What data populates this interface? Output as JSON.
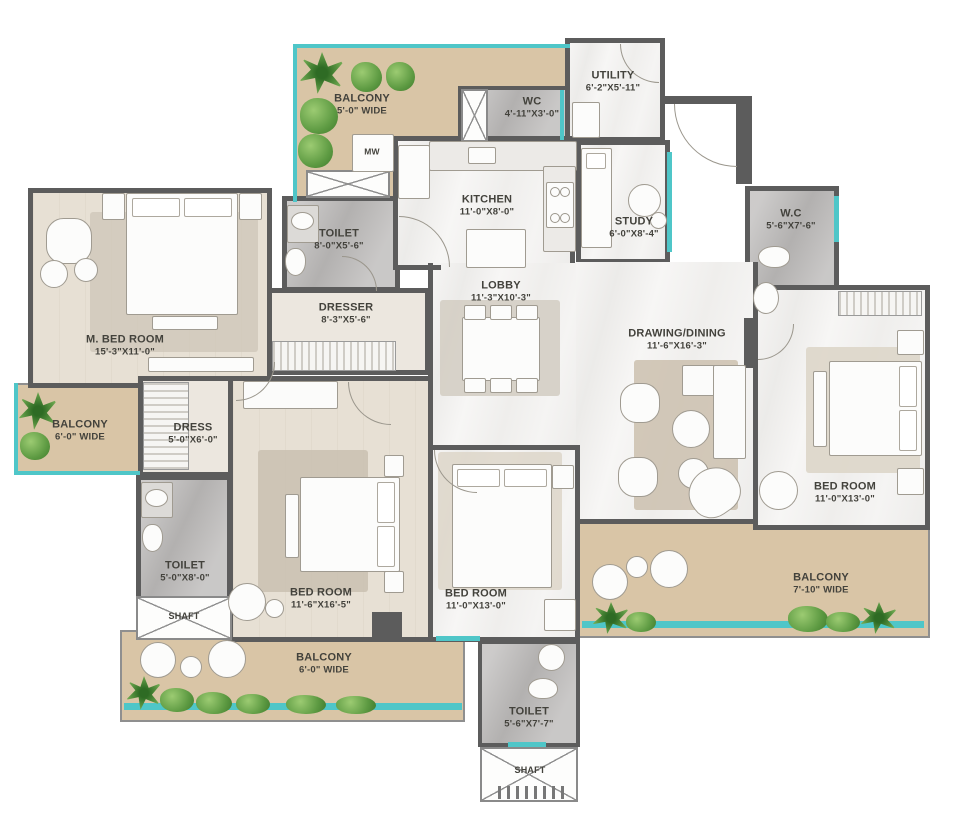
{
  "plan": {
    "title": "apartment-floor-plan",
    "colors": {
      "wall": "#5c5c5c",
      "balcony_floor": "#d9c5a6",
      "bedroom_floor": "#e7e0d4",
      "toilet_floor": "#bcbab9",
      "living_floor": "#f5f4f2",
      "window_accent": "#4fc6c8",
      "plant_green": "#5d9a42",
      "label_text": "#43423c"
    },
    "rooms": {
      "balcony_top": {
        "name": "BALCONY",
        "dims": "5'-0\" WIDE"
      },
      "wc_top": {
        "name": "WC",
        "dims": "4'-11\"X3'-0\""
      },
      "utility": {
        "name": "UTILITY",
        "dims": "6'-2\"X5'-11\""
      },
      "kitchen": {
        "name": "KITCHEN",
        "dims": "11'-0\"X8'-0\""
      },
      "study": {
        "name": "STUDY",
        "dims": "6'-0\"X8'-4\""
      },
      "wc_right": {
        "name": "W.C",
        "dims": "5'-6\"X7'-6\""
      },
      "toilet_top": {
        "name": "TOILET",
        "dims": "8'-0\"X5'-6\""
      },
      "dresser": {
        "name": "DRESSER",
        "dims": "8'-3\"X5'-6\""
      },
      "m_bedroom": {
        "name": "M. BED ROOM",
        "dims": "15'-3\"X11'-0\""
      },
      "lobby": {
        "name": "LOBBY",
        "dims": "11'-3\"X10'-3\""
      },
      "drawing_dining": {
        "name": "DRAWING/DINING",
        "dims": "11'-6\"X16'-3\""
      },
      "balcony_left": {
        "name": "BALCONY",
        "dims": "6'-0\" WIDE"
      },
      "dress": {
        "name": "DRESS",
        "dims": "5'-0\"X6'-0\""
      },
      "toilet_left": {
        "name": "TOILET",
        "dims": "5'-0\"X8'-0\""
      },
      "shaft_left": {
        "name": "SHAFT"
      },
      "bedroom_left": {
        "name": "BED ROOM",
        "dims": "11'-6\"X16'-5\""
      },
      "bedroom_center": {
        "name": "BED ROOM",
        "dims": "11'-0\"X13'-0\""
      },
      "balcony_bottom": {
        "name": "BALCONY",
        "dims": "6'-0\" WIDE"
      },
      "toilet_bottom": {
        "name": "TOILET",
        "dims": "5'-6\"X7'-7\""
      },
      "shaft_bottom": {
        "name": "SHAFT"
      },
      "bedroom_right": {
        "name": "BED ROOM",
        "dims": "11'-0\"X13'-0\""
      },
      "balcony_right": {
        "name": "BALCONY",
        "dims": "7'-10\" WIDE"
      }
    },
    "appliances": {
      "washer_label": "MW"
    }
  }
}
